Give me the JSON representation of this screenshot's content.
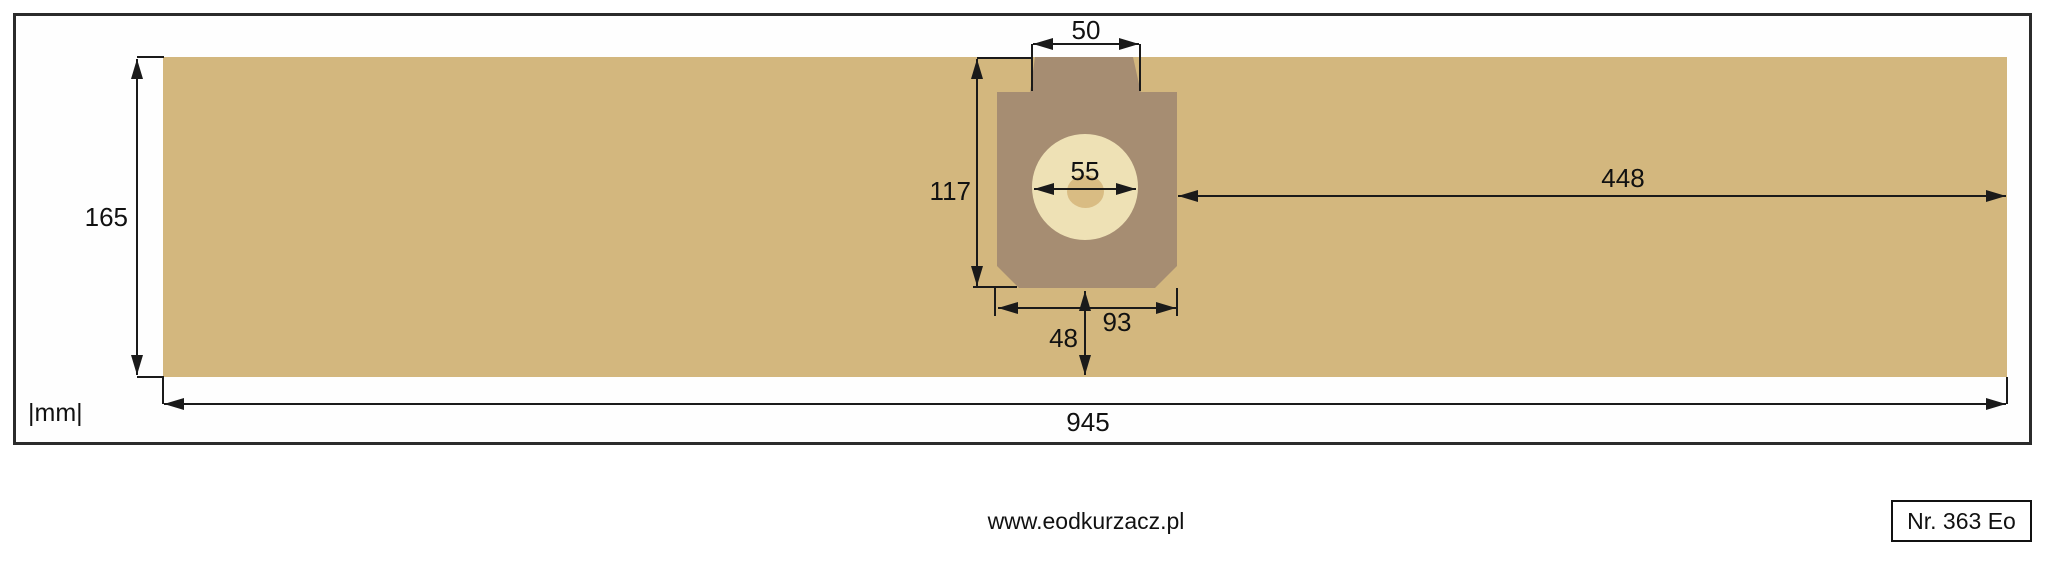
{
  "title": "Dust bag technical drawing",
  "units_label": "|mm|",
  "footer": {
    "website": "www.eodkurzacz.pl",
    "part_number": "Nr. 363 Eo"
  },
  "dimensions_mm": {
    "bag_length": "945",
    "bag_height": "165",
    "collar_top_width": "50",
    "plate_total_height": "117",
    "hole_diameter": "55",
    "plate_width": "93",
    "plate_to_right_edge": "448",
    "plate_bottom_to_bag_bottom": "48"
  },
  "colors": {
    "bag": "#d3b77e",
    "plate": "#a68d72",
    "hole_ring": "#eee1b5",
    "hole_center": "#d9bc83",
    "line": "#1a1a1a",
    "background": "#ffffff"
  }
}
